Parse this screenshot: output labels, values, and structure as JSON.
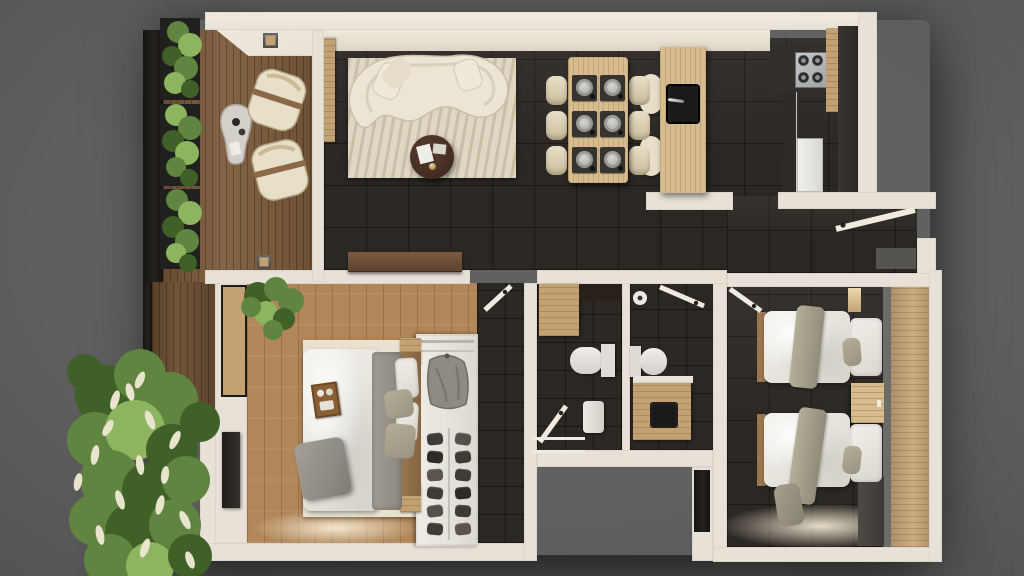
{
  "scene": {
    "kind": "3d-floor-plan-top-down-render",
    "rooms": [
      "balcony",
      "living-dining-kitchen",
      "entry-hall",
      "master-bedroom",
      "walk-in-closet",
      "hallway",
      "bathroom-shower",
      "bathroom-wc",
      "twin-bedroom"
    ],
    "objects": {
      "balcony": [
        "planter-boxes",
        "stone-coffee-table",
        "lounge-chairs",
        "wall-sconces"
      ],
      "living": [
        "curved-sofa",
        "area-rug",
        "round-coffee-table",
        "tv-console"
      ],
      "dining": [
        "table",
        "six-chairs",
        "six-place-settings"
      ],
      "kitchen": [
        "island-with-sink",
        "bar-stools",
        "gas-hob",
        "fridge",
        "tall-cabinets"
      ],
      "master-bedroom": [
        "double-bed",
        "breakfast-tray",
        "rug",
        "tv-panel",
        "plant",
        "shoe-wardrobe"
      ],
      "twin-bedroom": [
        "two-single-beds",
        "nightstand",
        "headboard-panel"
      ],
      "bathrooms": [
        "vanity",
        "toilet",
        "shower-tray",
        "washbasin"
      ]
    },
    "dining_chair_count": 6,
    "single_bed_count": 2
  },
  "palette": {
    "bg": "#616161",
    "bgDark": "#4b4b4b",
    "wall": "#e7e1d7",
    "wallBright": "#f0eadf",
    "wallShade": "#cfc9bf",
    "tile": "#2b2723",
    "deckWood": "#7d5c3c",
    "oakFloor": "#b1875a",
    "woodLight": "#d6bc8e",
    "woodMid": "#c2a173",
    "woodDark": "#8a6848",
    "panelWood": "#c7a678",
    "cream": "#e8dfc8",
    "sofaCream": "#ece5d4",
    "rugLiving": "#d8cdb6",
    "rugBed": "#eae2d0",
    "duvetWhite": "#edebe5",
    "grayBlanket": "#98948b",
    "sageGreen": "#a9a58e",
    "coffeeTable": "#4e352a",
    "console": "#6b4c36",
    "marble": "#d4d0c9",
    "steel": "#b8bcbd",
    "fridge": "#eae9e7",
    "blackFixture": "#1b1917",
    "charcoal": "#33302b",
    "green": "#5f8540",
    "greenDark": "#3f6128",
    "greenLight": "#8db45e",
    "tuft": "#e9e4cc",
    "doormat": "#56544f",
    "grayLedge": "#6e6c67"
  }
}
